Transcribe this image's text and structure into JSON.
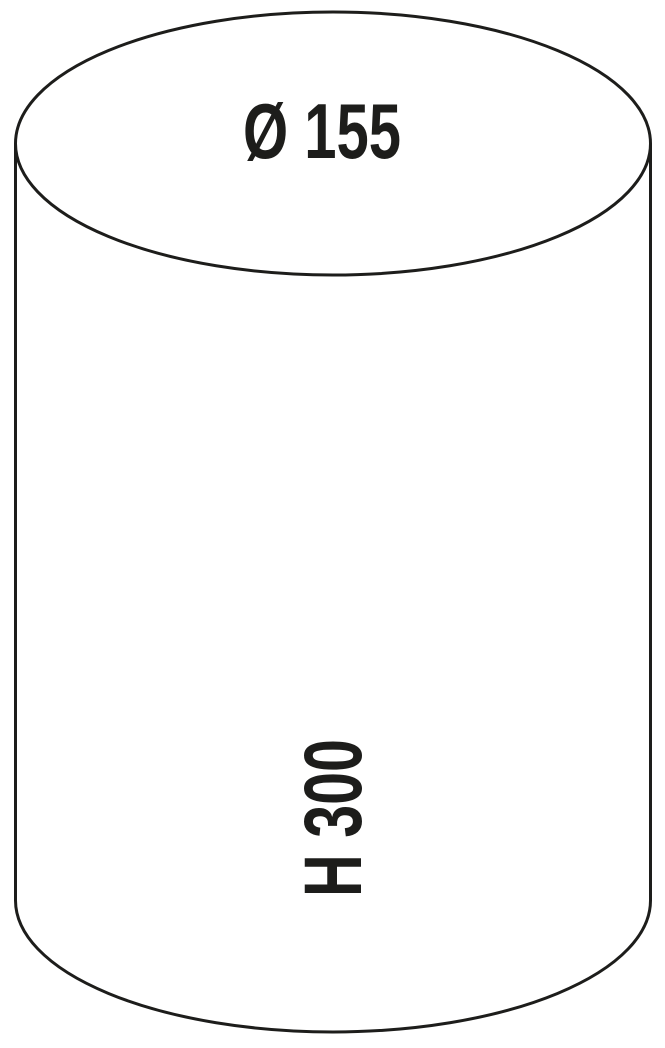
{
  "diagram": {
    "type": "cylinder-dimension-drawing",
    "diameter_label": "Ø 155",
    "height_label": "H 300",
    "line_color": "#1d1d1b",
    "text_color": "#1d1d1b",
    "background_color": "#ffffff"
  }
}
